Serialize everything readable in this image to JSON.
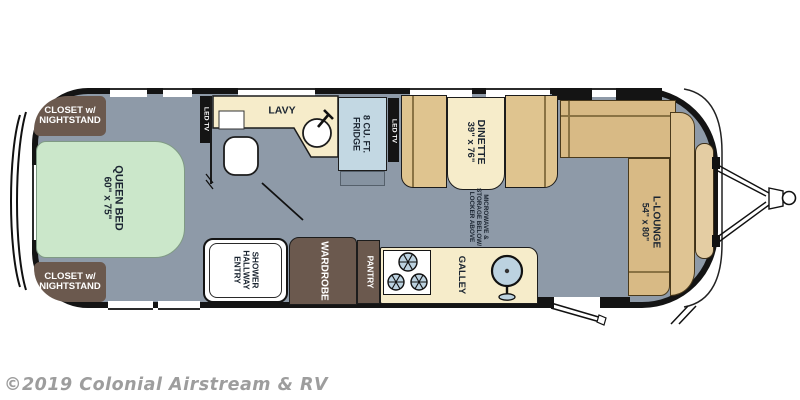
{
  "watermark": "©2019 Colonial Airstream & RV",
  "labels": {
    "closet": {
      "line1": "CLOSET w/",
      "line2": "NIGHTSTAND"
    },
    "queen_bed": {
      "name": "QUEEN BED",
      "dims": "60\" x 75\""
    },
    "led_tv": "LED TV",
    "lavy": "LAVY",
    "fridge": {
      "line1": "8 CU. FT.",
      "line2": "FRIDGE"
    },
    "dinette": {
      "name": "DINETTE",
      "dims": "39\" x 76\""
    },
    "microwave": {
      "line1": "MICROWAVE &",
      "line2": "STORAGE BELOW/",
      "line3": "LOCKER ABOVE"
    },
    "l_lounge": {
      "name": "L-LOUNGE",
      "dims": "54\" x 80\""
    },
    "shower": {
      "line1": "SHOWER",
      "line2": "HALLWAY",
      "line3": "ENTRY"
    },
    "wardrobe": "WARDROBE",
    "pantry": "PANTRY",
    "galley": "GALLEY"
  },
  "colors": {
    "floor": "#8e9aa8",
    "bed_green": "#cbe7ca",
    "cream": "#f6ecca",
    "bench_tan": "#dfc48f",
    "lounge_tan": "#d8ba85",
    "cabinet_brown": "#6b594e",
    "fridge_blue": "#c3d8e3",
    "appliance_blue": "#bcd2e0",
    "wall_black": "#141414",
    "label_navy": "#1b2531",
    "watermark_gray": "#9d9d9d"
  }
}
